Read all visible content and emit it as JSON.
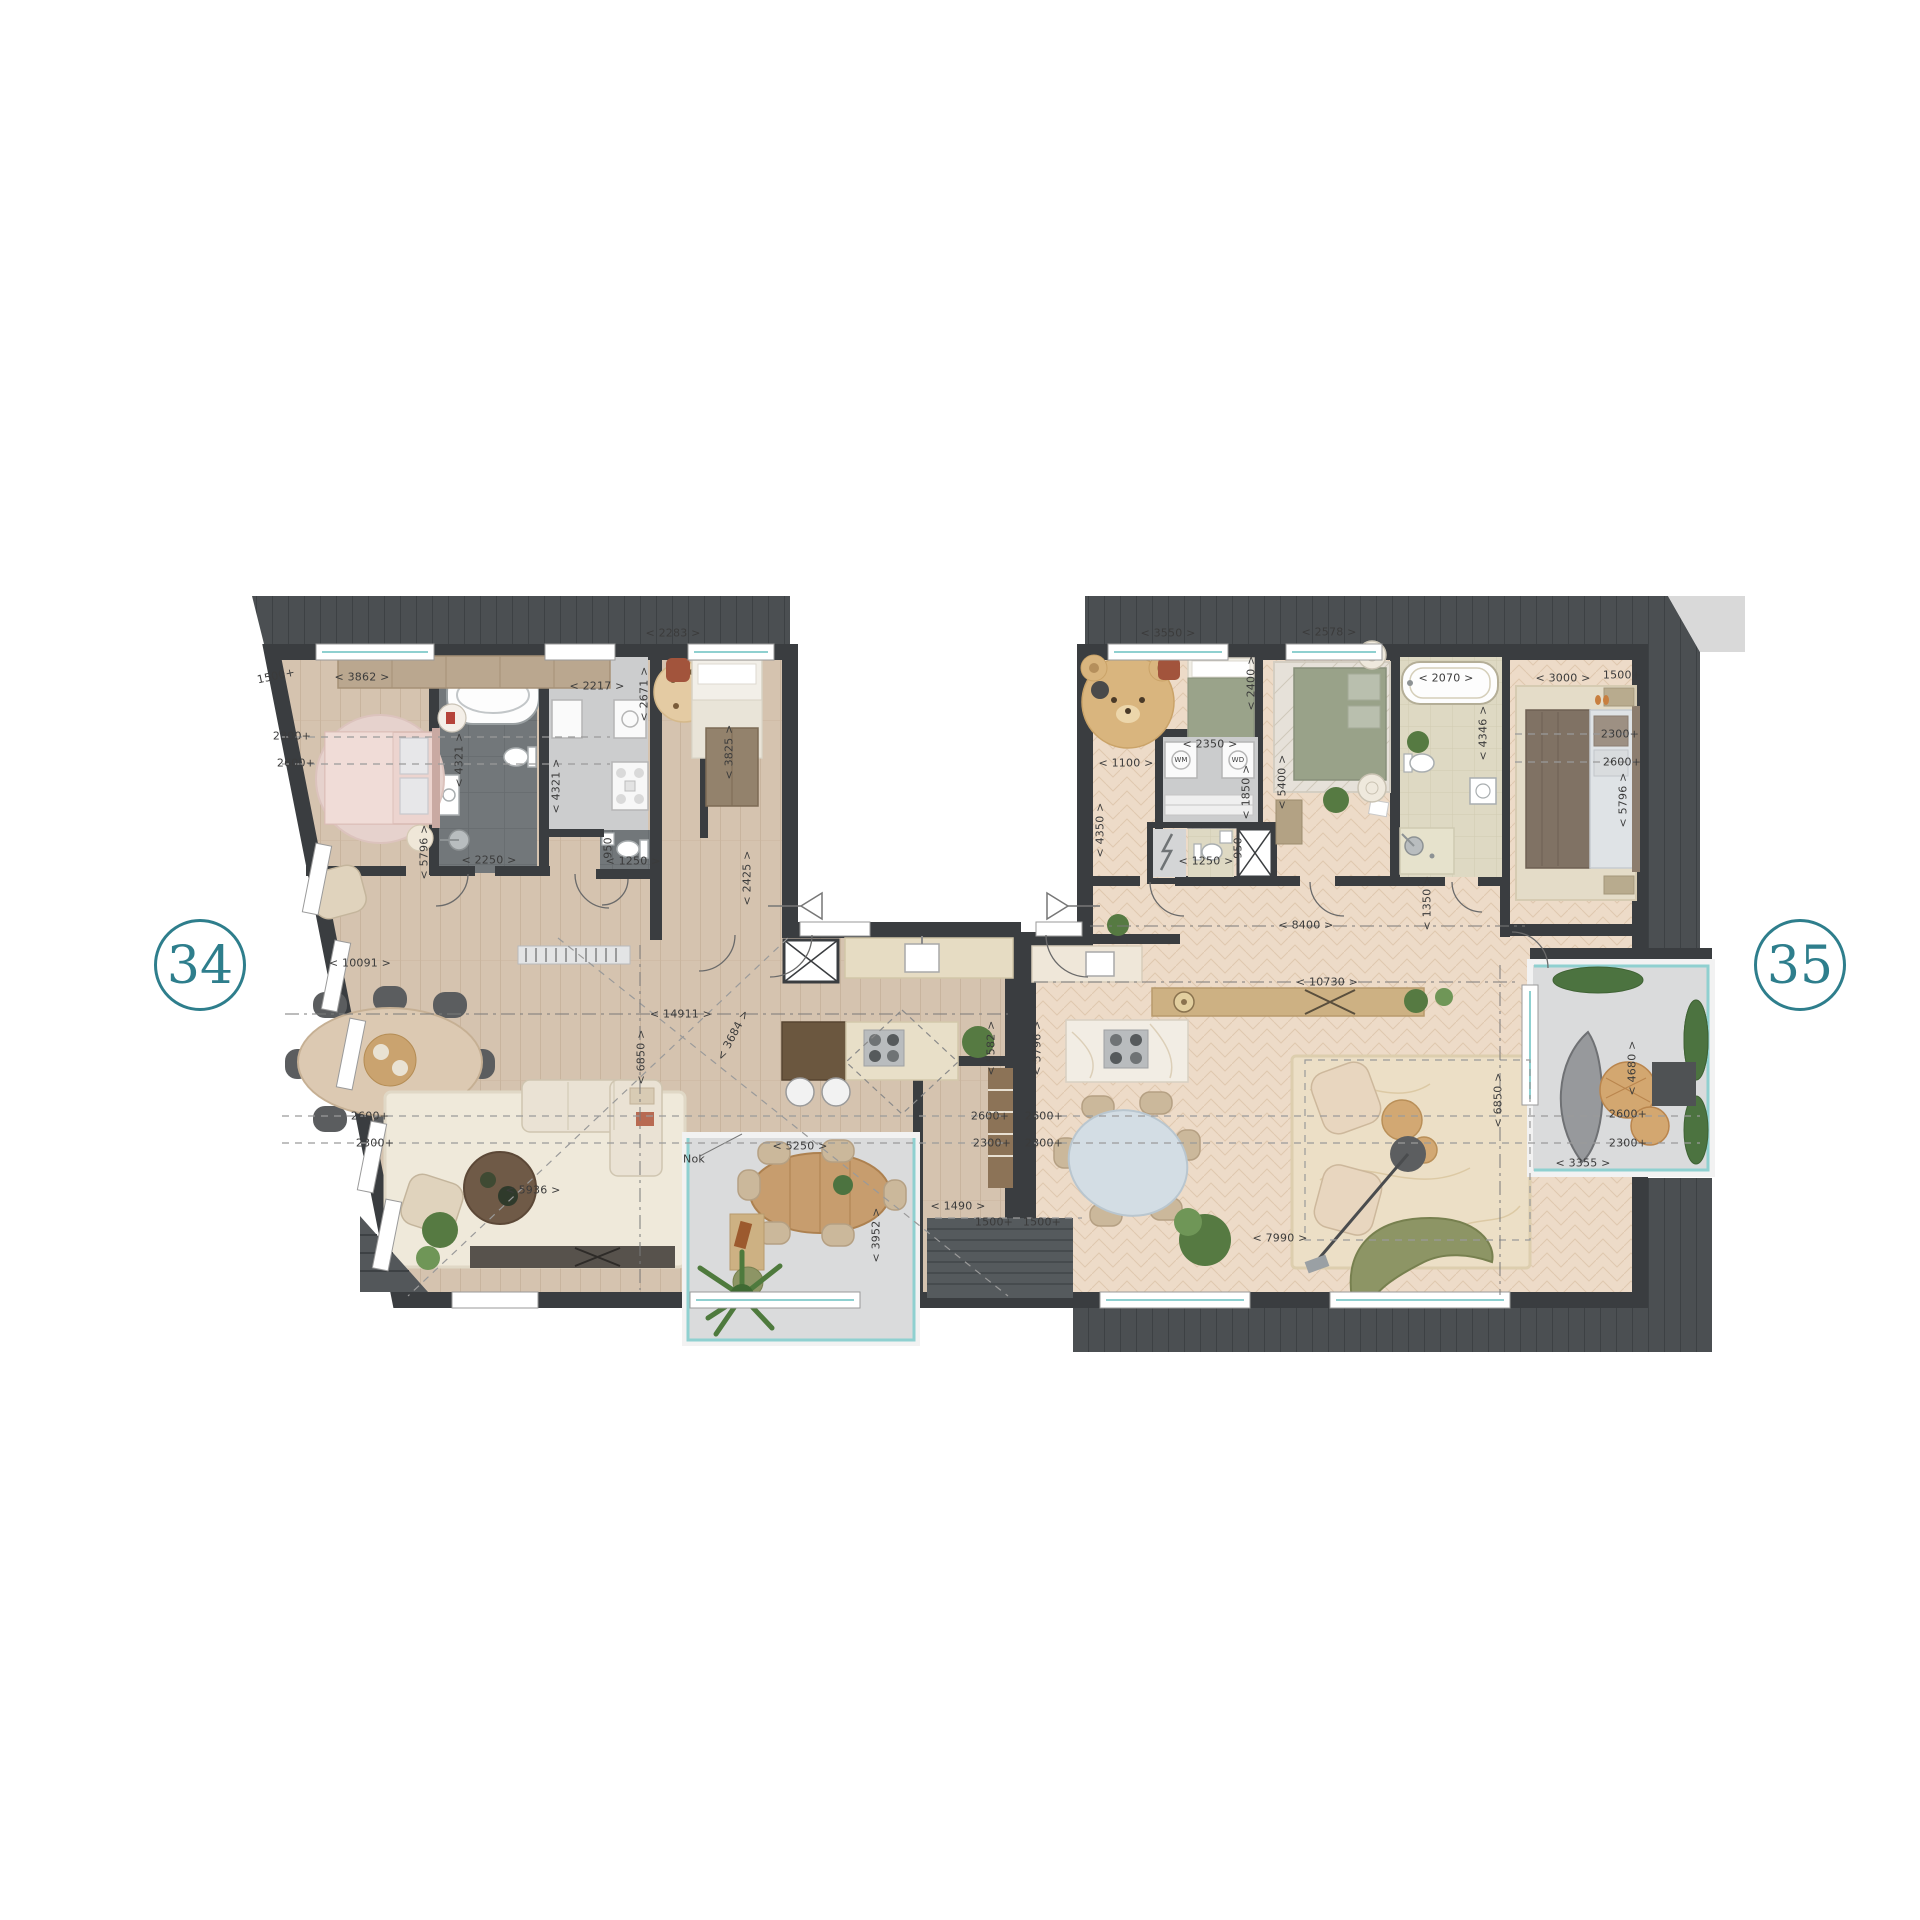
{
  "units": [
    {
      "number": "34"
    },
    {
      "number": "35"
    }
  ],
  "colors": {
    "accent_teal": "#2e7e8c",
    "wall": "#3a3d40",
    "deck": "#4b4f52",
    "floor_unit34": "#d5c3af",
    "floor_unit35": "#eddbc8",
    "bathroom_dark_tile": "#72777a",
    "bathroom_light_tile": "#ded9c3",
    "hall_gray": "#cccdce",
    "balcony_gray": "#dadbdc",
    "balustrade_glass": "#8fd0d0"
  },
  "icons": {
    "entrance_unit34": "triangle-left",
    "entrance_unit35": "triangle-right",
    "elevator_shaft": "crossed-box",
    "electrical_closet": "lightning-bolt"
  },
  "dimension_labels": [
    {
      "text": "1500+",
      "x": 276,
      "y": 676,
      "rot": -12
    },
    {
      "text": "< 3862 >",
      "x": 362,
      "y": 677,
      "rot": 0
    },
    {
      "text": "2300+",
      "x": 292,
      "y": 736,
      "rot": 0
    },
    {
      "text": "2600+",
      "x": 296,
      "y": 763,
      "rot": 0
    },
    {
      "text": "< 5796 >",
      "x": 424,
      "y": 852,
      "rot": -90
    },
    {
      "text": "< 4321 >",
      "x": 459,
      "y": 760,
      "rot": -90
    },
    {
      "text": "< 2250 >",
      "x": 489,
      "y": 860,
      "rot": 0
    },
    {
      "text": "< 2217 >",
      "x": 597,
      "y": 686,
      "rot": 0
    },
    {
      "text": "< 2671 >",
      "x": 644,
      "y": 694,
      "rot": -90
    },
    {
      "text": "< 4321 >",
      "x": 556,
      "y": 786,
      "rot": -90
    },
    {
      "text": "950",
      "x": 608,
      "y": 848,
      "rot": -90
    },
    {
      "text": "< 1250 >",
      "x": 633,
      "y": 861,
      "rot": 0
    },
    {
      "text": "< 2283 >",
      "x": 673,
      "y": 633,
      "rot": 0
    },
    {
      "text": "< 3825 >",
      "x": 729,
      "y": 752,
      "rot": -90
    },
    {
      "text": "< 2425 >",
      "x": 747,
      "y": 878,
      "rot": -90
    },
    {
      "text": "< 10091 >",
      "x": 360,
      "y": 963,
      "rot": 0
    },
    {
      "text": "< 14911 >",
      "x": 681,
      "y": 1014,
      "rot": 0
    },
    {
      "text": "< 6850 >",
      "x": 641,
      "y": 1057,
      "rot": -90
    },
    {
      "text": "< 3684 >",
      "x": 733,
      "y": 1035,
      "rot": -62
    },
    {
      "text": "2600+",
      "x": 370,
      "y": 1116,
      "rot": 0
    },
    {
      "text": "2300+",
      "x": 375,
      "y": 1143,
      "rot": 0
    },
    {
      "text": "< 5936 >",
      "x": 533,
      "y": 1190,
      "rot": 0
    },
    {
      "text": "Nok",
      "x": 694,
      "y": 1159,
      "rot": 0
    },
    {
      "text": "< 5250 >",
      "x": 800,
      "y": 1146,
      "rot": 0
    },
    {
      "text": "< 3952 >",
      "x": 876,
      "y": 1235,
      "rot": -90
    },
    {
      "text": "< 1490 >",
      "x": 958,
      "y": 1206,
      "rot": 0
    },
    {
      "text": "1500+",
      "x": 994,
      "y": 1222,
      "rot": 0
    },
    {
      "text": "2300+",
      "x": 992,
      "y": 1143,
      "rot": 0
    },
    {
      "text": "2600+",
      "x": 990,
      "y": 1116,
      "rot": 0
    },
    {
      "text": "< 5582 >",
      "x": 991,
      "y": 1048,
      "rot": -90
    },
    {
      "text": "< 5796 >",
      "x": 1037,
      "y": 1048,
      "rot": -90
    },
    {
      "text": "2600+",
      "x": 1044,
      "y": 1116,
      "rot": 0
    },
    {
      "text": "2300+",
      "x": 1044,
      "y": 1143,
      "rot": 0
    },
    {
      "text": "1500+",
      "x": 1042,
      "y": 1222,
      "rot": 0
    },
    {
      "text": "< 3550 >",
      "x": 1168,
      "y": 633,
      "rot": 0
    },
    {
      "text": "< 2400 >",
      "x": 1251,
      "y": 683,
      "rot": -90
    },
    {
      "text": "< 1100 >",
      "x": 1126,
      "y": 763,
      "rot": 0
    },
    {
      "text": "< 4350 >",
      "x": 1100,
      "y": 830,
      "rot": -90
    },
    {
      "text": "< 2350 >",
      "x": 1210,
      "y": 744,
      "rot": 0
    },
    {
      "text": "< 1850 >",
      "x": 1246,
      "y": 792,
      "rot": -90
    },
    {
      "text": "< 2578 >",
      "x": 1329,
      "y": 632,
      "rot": 0
    },
    {
      "text": "< 5400 >",
      "x": 1282,
      "y": 782,
      "rot": -90
    },
    {
      "text": "< 2070 >",
      "x": 1446,
      "y": 678,
      "rot": 0
    },
    {
      "text": "< 4346 >",
      "x": 1483,
      "y": 733,
      "rot": -90
    },
    {
      "text": "< 3000 >",
      "x": 1563,
      "y": 678,
      "rot": 0
    },
    {
      "text": "1500+",
      "x": 1622,
      "y": 675,
      "rot": 0
    },
    {
      "text": "2300+",
      "x": 1620,
      "y": 734,
      "rot": 0
    },
    {
      "text": "2600+",
      "x": 1622,
      "y": 762,
      "rot": 0
    },
    {
      "text": "< 5796 >",
      "x": 1623,
      "y": 800,
      "rot": -90
    },
    {
      "text": "< 8400 >",
      "x": 1306,
      "y": 925,
      "rot": 0
    },
    {
      "text": "< 1350 >",
      "x": 1427,
      "y": 903,
      "rot": -90
    },
    {
      "text": "< 10730 >",
      "x": 1327,
      "y": 982,
      "rot": 0
    },
    {
      "text": "< 1250 >",
      "x": 1206,
      "y": 861,
      "rot": 0
    },
    {
      "text": "950",
      "x": 1238,
      "y": 848,
      "rot": -90
    },
    {
      "text": "< 7990 >",
      "x": 1280,
      "y": 1238,
      "rot": 0
    },
    {
      "text": "< 6850 >",
      "x": 1498,
      "y": 1100,
      "rot": -90
    },
    {
      "text": "< 4680 >",
      "x": 1632,
      "y": 1068,
      "rot": -90
    },
    {
      "text": "2600+",
      "x": 1628,
      "y": 1114,
      "rot": 0
    },
    {
      "text": "2300+",
      "x": 1628,
      "y": 1143,
      "rot": 0
    },
    {
      "text": "< 3355 >",
      "x": 1583,
      "y": 1163,
      "rot": 0
    },
    {
      "text": "WM",
      "x": 1181,
      "y": 760,
      "rot": 0,
      "s": 7
    },
    {
      "text": "WD",
      "x": 1238,
      "y": 760,
      "rot": 0,
      "s": 7
    }
  ]
}
